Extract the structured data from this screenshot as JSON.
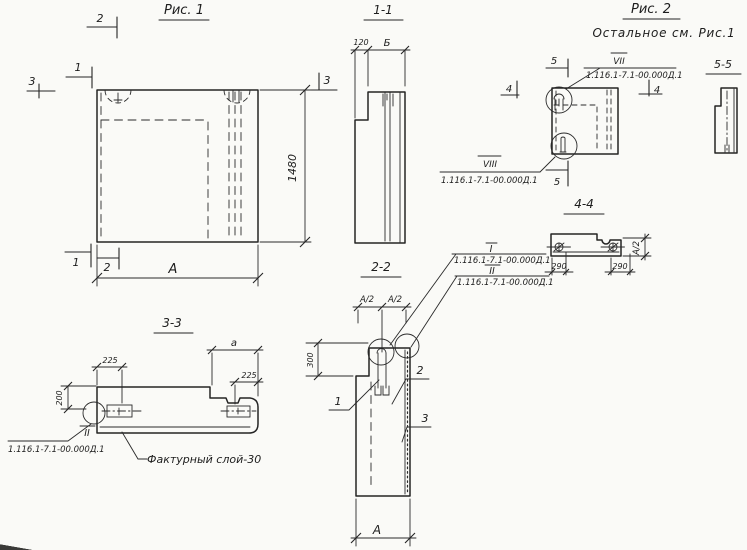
{
  "colors": {
    "paper": "#fafaf7",
    "ink": "#242424"
  },
  "drawing": {
    "figure1": {
      "title": "Рис. 1",
      "dim_height": "1480",
      "dim_width": "А",
      "mark_top_2": "2",
      "mark_top_1": "1",
      "mark_left_3": "3",
      "mark_right_3": "3",
      "mark_bottom_1": "1",
      "mark_bottom_2": "2"
    },
    "section11": {
      "title": "1-1",
      "dim_120": "120",
      "dim_b": "Б"
    },
    "section22": {
      "title": "2-2",
      "dim_a2_left": "А/2",
      "dim_a2_right": "А/2",
      "dim_300": "300",
      "dim_width": "А",
      "part1": "1",
      "part2": "2",
      "part3": "3"
    },
    "callout_i": {
      "roman": "I",
      "designation": "1.116.1-7.1-00.000Д.1"
    },
    "callout_ii": {
      "roman": "II",
      "designation": "1.116.1-7.1-00.000Д.1"
    },
    "section33": {
      "title": "3-3",
      "dim_225_left": "225",
      "dim_a": "а",
      "dim_225_right": "225",
      "dim_200": "200",
      "callout_roman": "II",
      "callout_designation": "1.116.1-7.1-00.000Д.1",
      "note": "Фактурный слой-30"
    },
    "figure2": {
      "title": "Рис. 2",
      "subtitle": "Остальное см. Рис.1",
      "callout_top_roman": "VII",
      "callout_top_designation": "1.116.1-7.1-00.000Д.1",
      "callout_bottom_roman": "VIII",
      "callout_bottom_designation": "1.116.1-7.1-00.000Д.1",
      "mark_5_top": "5",
      "mark_5_bottom": "5",
      "mark_4_left": "4",
      "mark_4_right": "4"
    },
    "section55": {
      "title": "5-5"
    },
    "section44": {
      "title": "4-4",
      "dim_290_left": "290",
      "dim_290_right": "290",
      "dim_a2": "А/2"
    }
  }
}
